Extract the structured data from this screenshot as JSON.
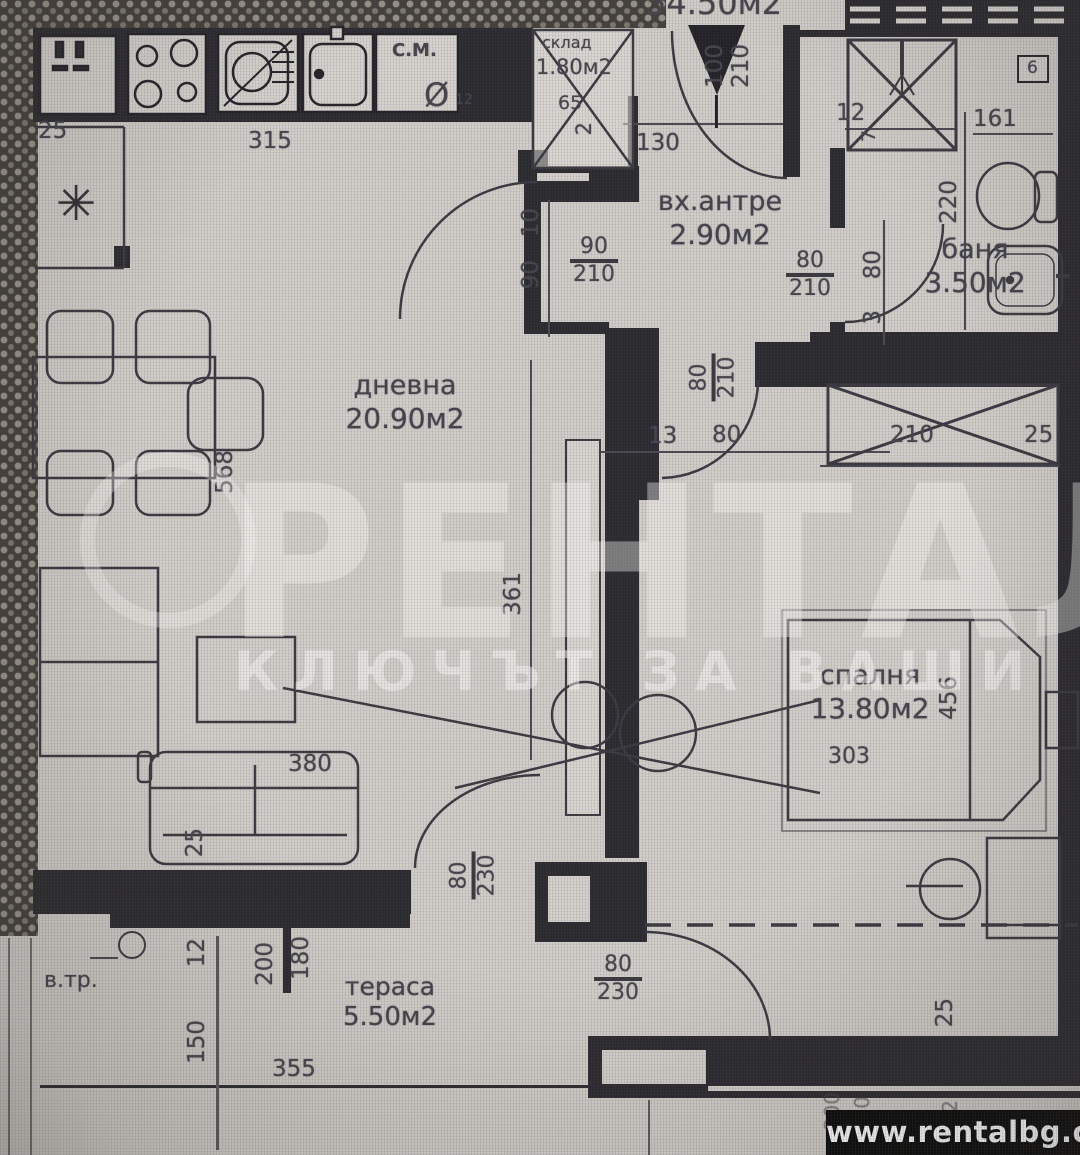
{
  "total_area": "54.50м2",
  "watermark": {
    "brand": "РЕНТАЛ",
    "slogan": "КЛЮЧЪТ ЗА ВАШИ",
    "website": "www.rentalbg.com"
  },
  "rooms": {
    "living": {
      "name": "дневна",
      "area": "20.90м2"
    },
    "entrance": {
      "name": "вх.антре",
      "area": "2.90м2"
    },
    "bath": {
      "name": "баня",
      "area": "3.50м2"
    },
    "bedroom": {
      "name": "спалня",
      "area": "13.80м2"
    },
    "terrace": {
      "name": "тераса",
      "area": "5.50м2"
    },
    "storage": {
      "name": "склад",
      "area": "1.80м2",
      "d1": "65",
      "d2": "2"
    }
  },
  "labels": {
    "cm": "С.М.",
    "vtr": "в.тр.",
    "diameter": "Ø",
    "dia12": "12",
    "shaft6": "6",
    "asterisk": "✳"
  },
  "dims": {
    "kitchen_width": "315",
    "niche": "25",
    "entry_door": {
      "w": "100",
      "h": "210"
    },
    "hall_width": "130",
    "living_door": {
      "w": "90",
      "h": "210"
    },
    "wall_seg_10": "10",
    "wall_seg_90": "90",
    "bath_door": {
      "w": "80",
      "h": "210"
    },
    "bedroom_door": {
      "w": "80",
      "h": "210"
    },
    "bedroom_door_13": "13",
    "bedroom_door_80": "80",
    "shower_12": "12",
    "shower_7": "7",
    "bath_161": "161",
    "bath_220": "220",
    "bath_80": "80",
    "bath_3": "3",
    "table_568": "568",
    "wall_361": "361",
    "sofa_380": "380",
    "sofa_25": "25",
    "bed_303": "303",
    "bed_456": "456",
    "wardrobe_210": "210",
    "wardrobe_25": "25",
    "proj_25": "25",
    "terrace_door": {
      "w": "80",
      "h": "230"
    },
    "bedroom_terrace_door": {
      "w": "80",
      "h": "230"
    },
    "ter_12": "12",
    "ter_150": "150",
    "ter_200": "200",
    "ter_180": "180",
    "ter_355": "355",
    "br_200": "200",
    "br_80": "80",
    "br_2": "2"
  }
}
